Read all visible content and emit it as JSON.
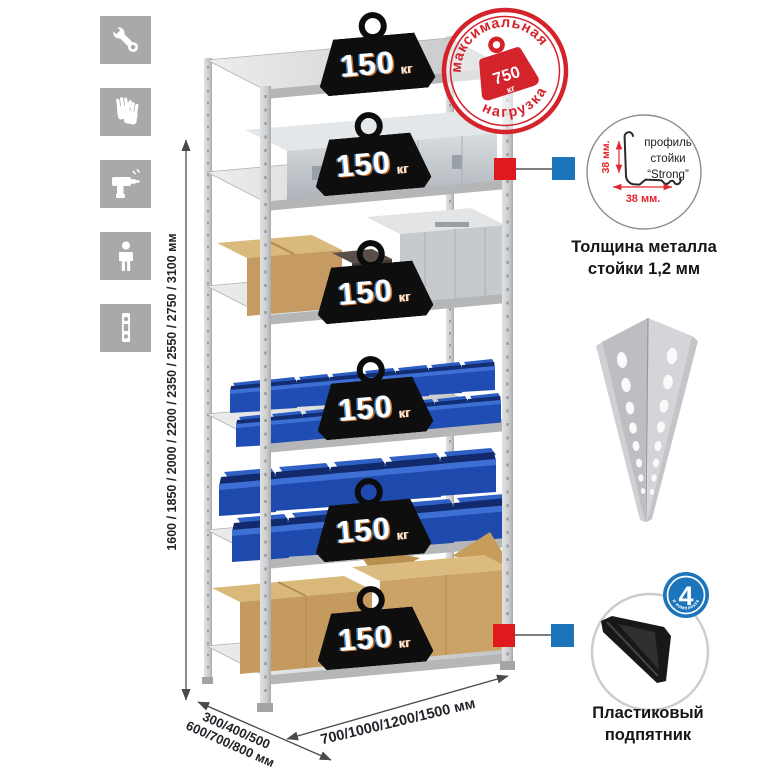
{
  "sidebar": {
    "tile_color": "#a9a9a9",
    "icons": [
      {
        "name": "wrench-icon"
      },
      {
        "name": "gloves-icon"
      },
      {
        "name": "drill-icon"
      },
      {
        "name": "person-icon"
      },
      {
        "name": "level-icon"
      }
    ]
  },
  "rack": {
    "weights": [
      {
        "value": "150",
        "unit": "кг"
      },
      {
        "value": "150",
        "unit": "кг"
      },
      {
        "value": "150",
        "unit": "кг"
      },
      {
        "value": "150",
        "unit": "кг"
      },
      {
        "value": "150",
        "unit": "кг"
      },
      {
        "value": "150",
        "unit": "кг"
      }
    ],
    "stamp": {
      "arc_top": "максимальная",
      "arc_bottom": "нагрузка",
      "value": "750",
      "unit": "кг"
    }
  },
  "dimensions": {
    "height_label": "1600 / 1850 / 2000 / 2200 / 2350 / 2550 / 2750 / 3100 мм",
    "depth_label_line1": "300/400/500",
    "depth_label_line2": "600/700/800 мм",
    "width_label": "700/1000/1200/1500 мм"
  },
  "profile_detail": {
    "label_line1": "профиль",
    "label_line2": "стойки",
    "label_line3": "“Strong”",
    "dim_vertical": "38 мм.",
    "dim_horizontal": "38 мм.",
    "caption_line1": "Толщина металла",
    "caption_line2": "стойки 1,2 мм"
  },
  "foot_detail": {
    "badge_value": "4",
    "badge_arc": "в комплекте",
    "caption_line1": "Пластиковый",
    "caption_line2": "подпятник"
  },
  "colors": {
    "stamp_red": "#d5232b",
    "connector_red": "#e0191f",
    "connector_blue": "#1c75bb",
    "bin_blue": "#1e4aad",
    "dim_red": "#e3262d",
    "metal_gray": "#d0d2d4"
  }
}
